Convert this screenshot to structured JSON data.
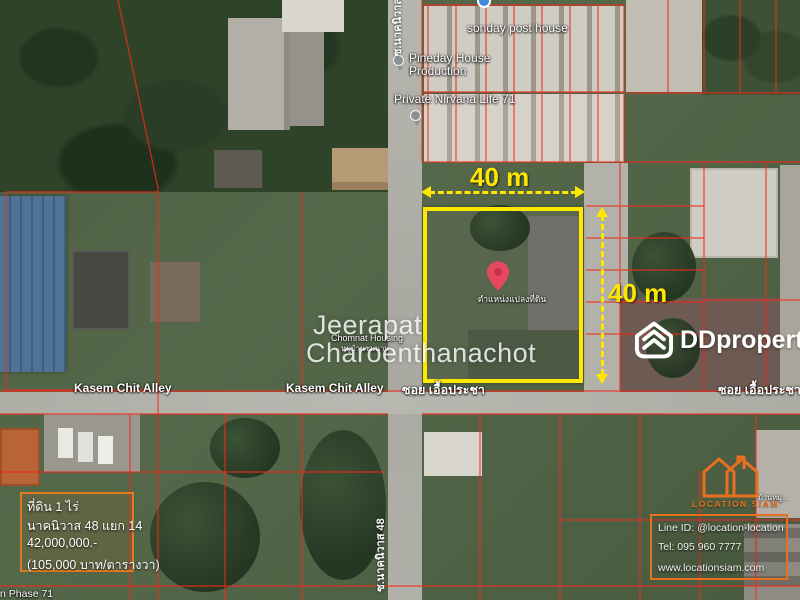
{
  "colors": {
    "highlight_yellow": "#ffe600",
    "parcel_red": "#f22b1c",
    "brand_orange": "#e8701f",
    "pin_red": "#e8485f"
  },
  "poi": {
    "sonday": "sonday post house",
    "pineday1": "Pineday House",
    "pineday2": "Production",
    "nirvana": "Private Nirvana Life 71",
    "chomnat": "Chomnat Housing",
    "chomnat_th": "หมู่บ้านชมนาท",
    "baan_edge": "บ้านหมู่...",
    "phase71": "n Phase 71"
  },
  "roads": {
    "kasem_left": "Kasem Chit Alley",
    "kasem_center": "Kasem Chit Alley",
    "soi_center": "ซอย เอื้อประชา",
    "soi_right": "ซอย เอื้อประชา",
    "soi_vertical_bottom": "ซ.นาคนิวาส 48",
    "soi_vertical_top": "ซ.นาคนิวาส"
  },
  "plot": {
    "width_label": "40 m",
    "height_label": "40 m",
    "marker_label": "ตำแหน่งแปลงที่ดิน"
  },
  "watermark": {
    "line1": "Jeerapat",
    "line2": "Charoenthanachot"
  },
  "brand": {
    "name": "DDproperty"
  },
  "listing": {
    "area": "ที่ดิน 1 ไร่",
    "location": "นาคนิวาส 48 แยก 14",
    "price": "42,000,000.-",
    "price_per_unit": "(105,000 บาท/ตารางวา)"
  },
  "agency": {
    "brand": "LOCATION SIAM",
    "line_id": "Line ID: @location-location",
    "tel": "Tel: 095 960 7777",
    "website": "www.locationsiam.com"
  }
}
